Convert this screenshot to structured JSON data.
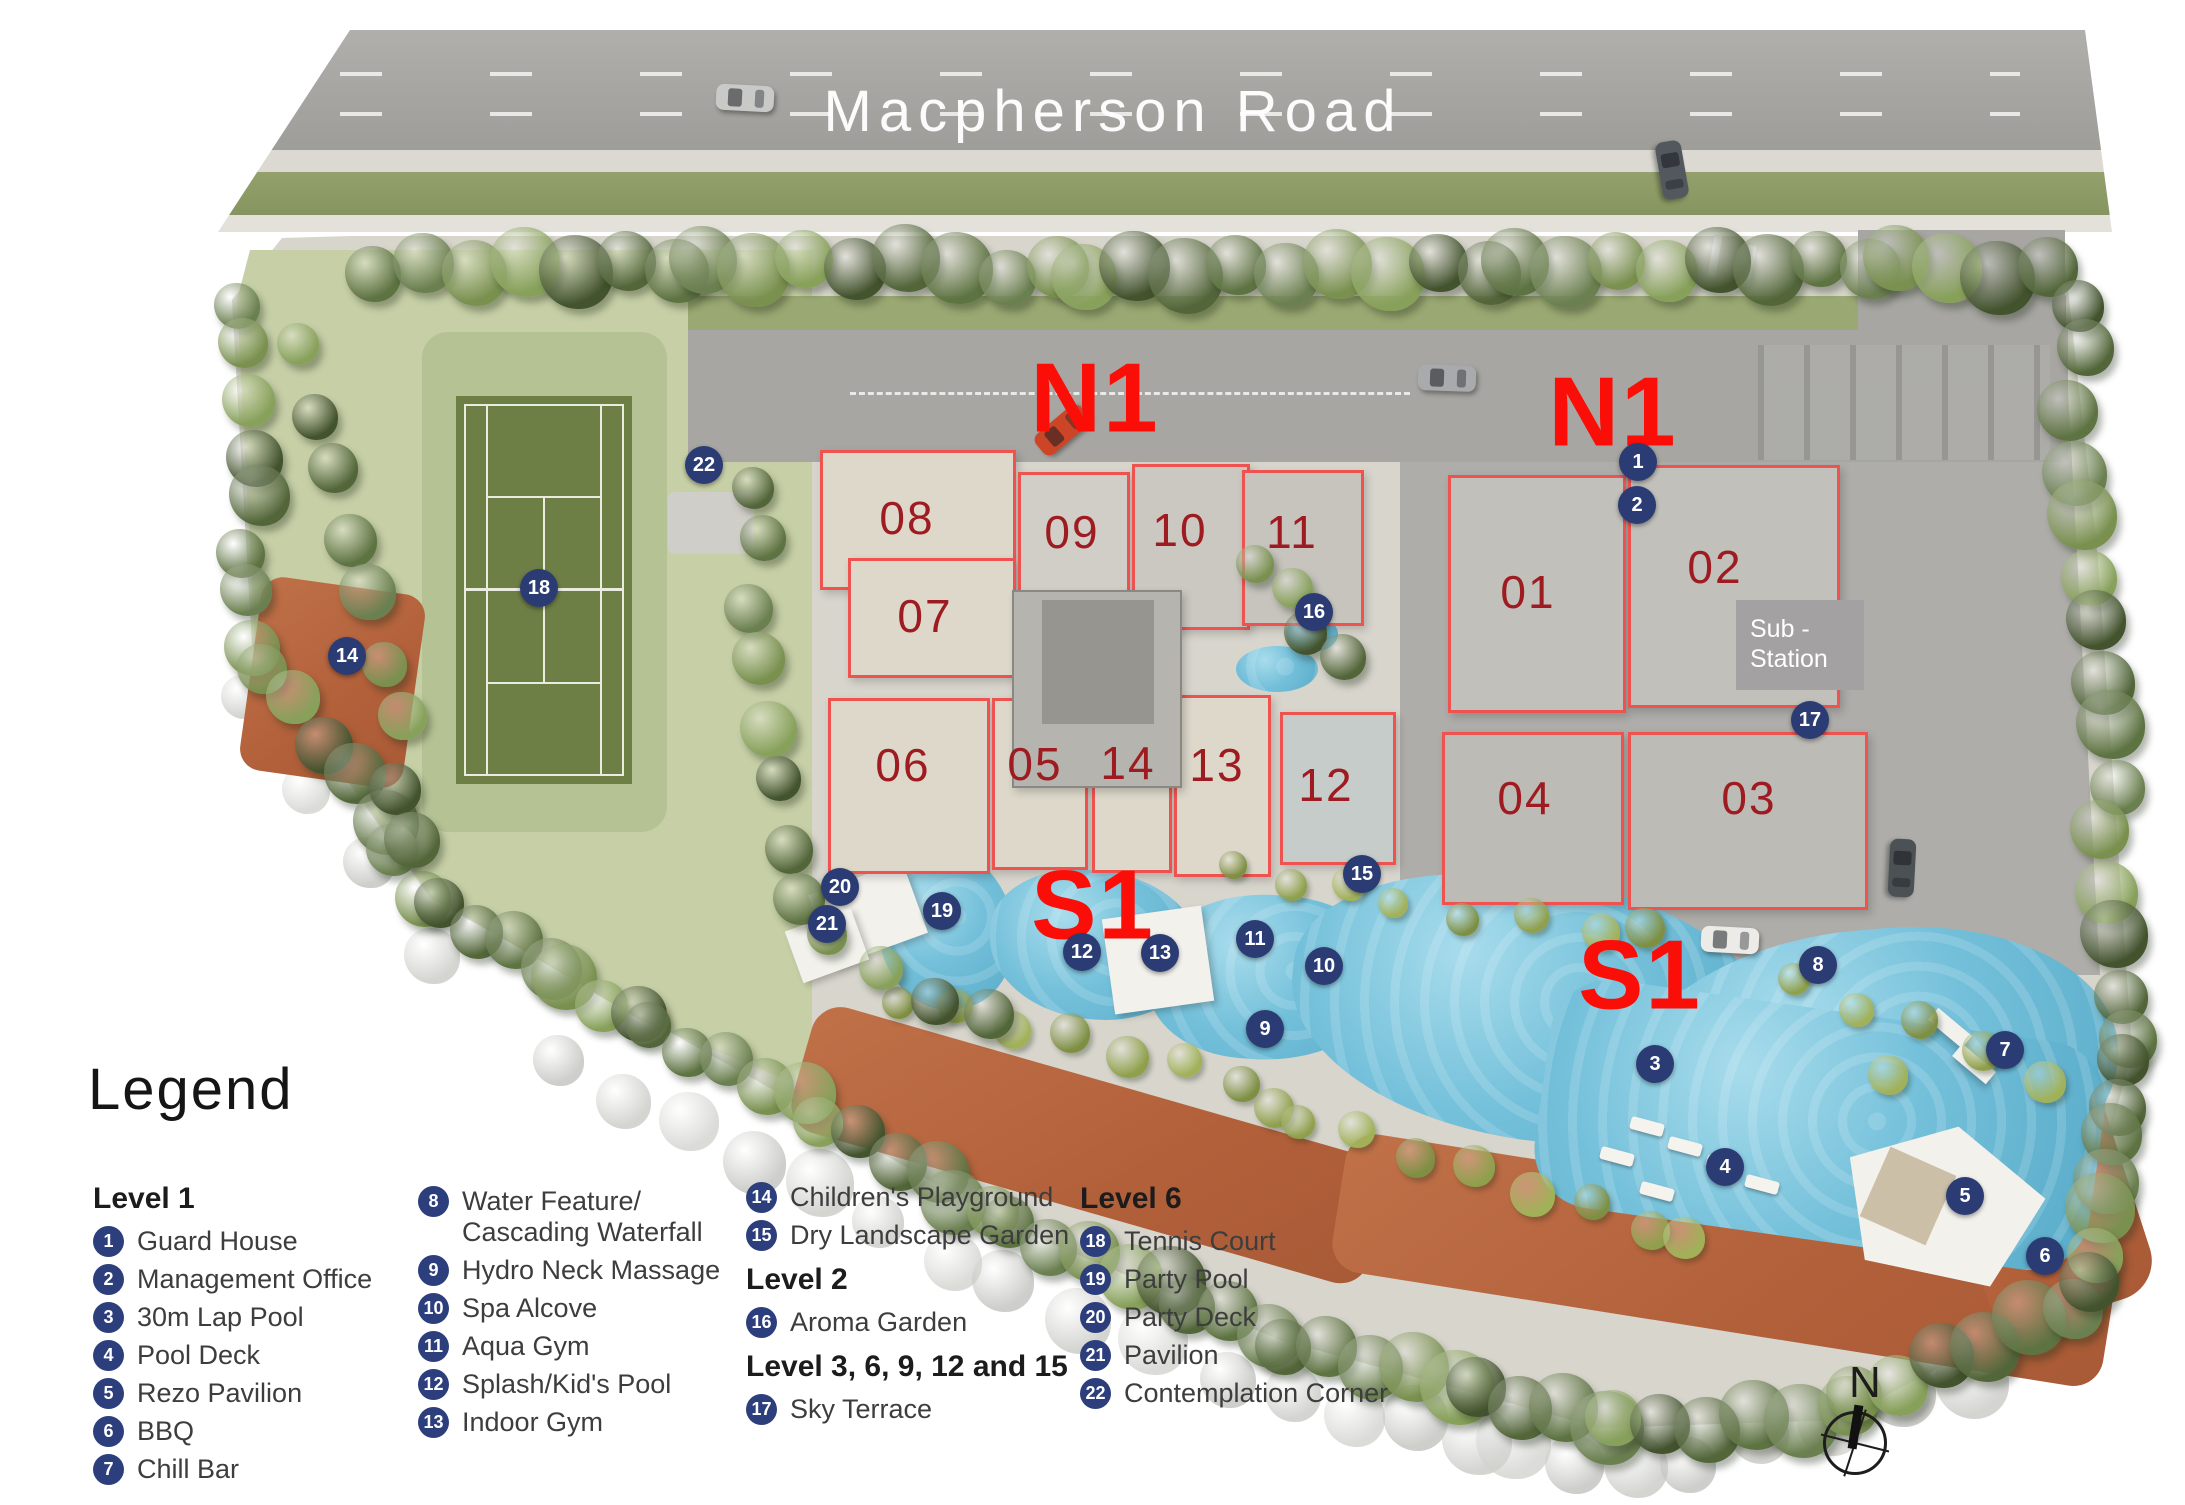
{
  "map": {
    "road_name": "Macpherson Road",
    "compass_label": "N",
    "substation": {
      "line1": "Sub -",
      "line2": "Station"
    },
    "zone_labels": [
      {
        "text": "N1",
        "x": 1095,
        "y": 398
      },
      {
        "text": "N1",
        "x": 1613,
        "y": 412
      },
      {
        "text": "S1",
        "x": 1093,
        "y": 905
      },
      {
        "text": "S1",
        "x": 1640,
        "y": 975
      }
    ],
    "buildings": [
      {
        "label": "01",
        "x": 1528,
        "y": 592
      },
      {
        "label": "02",
        "x": 1715,
        "y": 567
      },
      {
        "label": "03",
        "x": 1749,
        "y": 798
      },
      {
        "label": "04",
        "x": 1525,
        "y": 798
      },
      {
        "label": "05",
        "x": 1035,
        "y": 764
      },
      {
        "label": "06",
        "x": 903,
        "y": 765
      },
      {
        "label": "07",
        "x": 925,
        "y": 616
      },
      {
        "label": "08",
        "x": 907,
        "y": 518
      },
      {
        "label": "09",
        "x": 1072,
        "y": 532
      },
      {
        "label": "10",
        "x": 1180,
        "y": 530
      },
      {
        "label": "11",
        "x": 1292,
        "y": 532
      },
      {
        "label": "12",
        "x": 1326,
        "y": 785
      },
      {
        "label": "13",
        "x": 1217,
        "y": 765
      },
      {
        "label": "14",
        "x": 1128,
        "y": 763
      }
    ],
    "markers": [
      {
        "n": "1",
        "x": 1638,
        "y": 462
      },
      {
        "n": "2",
        "x": 1637,
        "y": 505
      },
      {
        "n": "3",
        "x": 1655,
        "y": 1064
      },
      {
        "n": "4",
        "x": 1725,
        "y": 1167
      },
      {
        "n": "5",
        "x": 1965,
        "y": 1196
      },
      {
        "n": "6",
        "x": 2045,
        "y": 1256
      },
      {
        "n": "7",
        "x": 2005,
        "y": 1050
      },
      {
        "n": "8",
        "x": 1818,
        "y": 965
      },
      {
        "n": "9",
        "x": 1265,
        "y": 1029
      },
      {
        "n": "10",
        "x": 1324,
        "y": 966
      },
      {
        "n": "11",
        "x": 1255,
        "y": 939
      },
      {
        "n": "12",
        "x": 1082,
        "y": 952
      },
      {
        "n": "13",
        "x": 1160,
        "y": 953
      },
      {
        "n": "14",
        "x": 347,
        "y": 656
      },
      {
        "n": "15",
        "x": 1362,
        "y": 874
      },
      {
        "n": "16",
        "x": 1314,
        "y": 612
      },
      {
        "n": "17",
        "x": 1810,
        "y": 720
      },
      {
        "n": "18",
        "x": 539,
        "y": 588
      },
      {
        "n": "19",
        "x": 942,
        "y": 911
      },
      {
        "n": "20",
        "x": 840,
        "y": 887
      },
      {
        "n": "21",
        "x": 827,
        "y": 924
      },
      {
        "n": "22",
        "x": 704,
        "y": 465
      }
    ]
  },
  "legend": {
    "title": "Legend",
    "columns": [
      {
        "rows": [
          {
            "type": "header",
            "text": "Level 1"
          },
          {
            "type": "item",
            "num": "1",
            "label": "Guard House"
          },
          {
            "type": "item",
            "num": "2",
            "label": "Management Office"
          },
          {
            "type": "item",
            "num": "3",
            "label": "30m Lap Pool"
          },
          {
            "type": "item",
            "num": "4",
            "label": "Pool Deck"
          },
          {
            "type": "item",
            "num": "5",
            "label": "Rezo Pavilion"
          },
          {
            "type": "item",
            "num": "6",
            "label": "BBQ"
          },
          {
            "type": "item",
            "num": "7",
            "label": "Chill Bar"
          }
        ]
      },
      {
        "rows": [
          {
            "type": "item",
            "num": "8",
            "label": "Water Feature/\nCascading Waterfall"
          },
          {
            "type": "item",
            "num": "9",
            "label": "Hydro Neck Massage"
          },
          {
            "type": "item",
            "num": "10",
            "label": "Spa Alcove"
          },
          {
            "type": "item",
            "num": "11",
            "label": "Aqua Gym"
          },
          {
            "type": "item",
            "num": "12",
            "label": "Splash/Kid's Pool"
          },
          {
            "type": "item",
            "num": "13",
            "label": "Indoor Gym"
          }
        ]
      },
      {
        "rows": [
          {
            "type": "item",
            "num": "14",
            "label": "Children's Playground"
          },
          {
            "type": "item",
            "num": "15",
            "label": "Dry Landscape Garden"
          },
          {
            "type": "header",
            "text": "Level 2"
          },
          {
            "type": "item",
            "num": "16",
            "label": "Aroma Garden"
          },
          {
            "type": "header",
            "text": "Level 3, 6, 9, 12 and 15"
          },
          {
            "type": "item",
            "num": "17",
            "label": "Sky Terrace"
          }
        ]
      },
      {
        "rows": [
          {
            "type": "header",
            "text": "Level 6"
          },
          {
            "type": "item",
            "num": "18",
            "label": "Tennis Court"
          },
          {
            "type": "item",
            "num": "19",
            "label": "Party Pool"
          },
          {
            "type": "item",
            "num": "20",
            "label": "Party Deck"
          },
          {
            "type": "item",
            "num": "21",
            "label": "Pavilion"
          },
          {
            "type": "item",
            "num": "22",
            "label": "Contemplation Corner"
          }
        ]
      }
    ]
  },
  "colors": {
    "zone_label": "#fb0e08",
    "building_number": "#9e1c21",
    "marker_bg": "#2b3c74",
    "legend_badge": "#2c3f7c",
    "outline_red": "#ef5350",
    "pool": "#6fbcd9"
  }
}
